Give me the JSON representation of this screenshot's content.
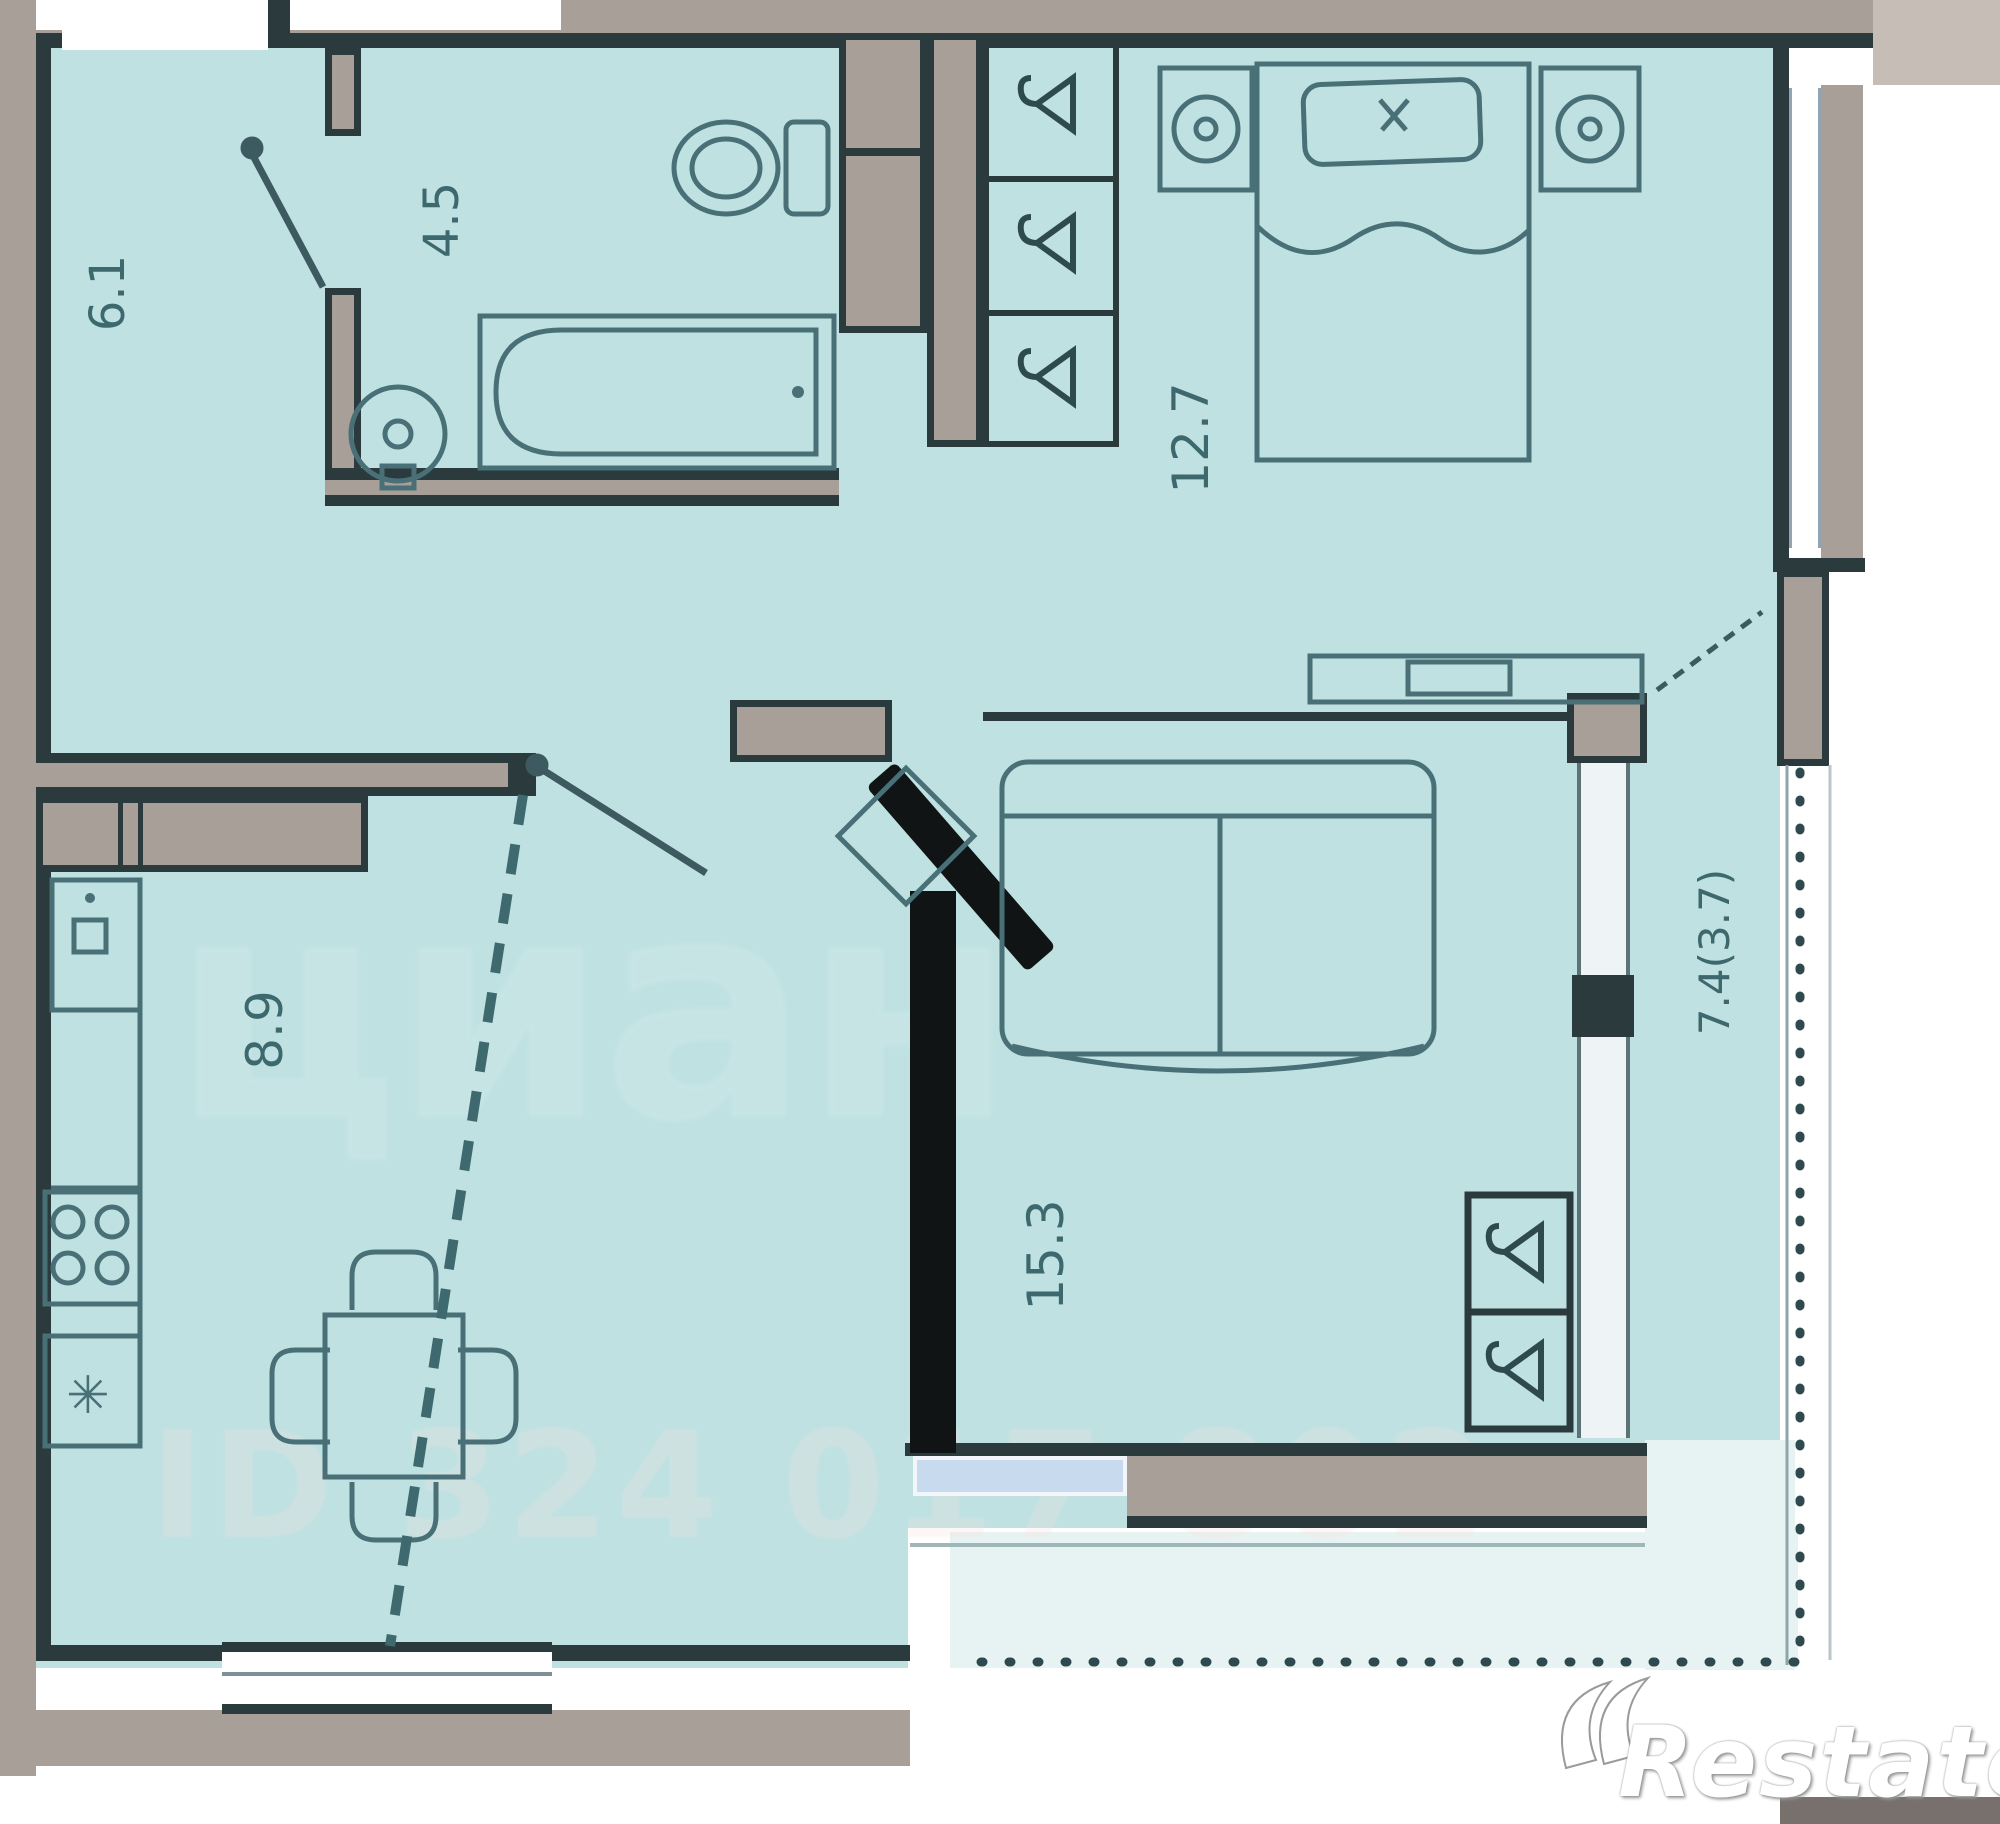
{
  "plan": {
    "type": "apartment-floor-plan",
    "rooms": [
      {
        "id": "hallway",
        "area": "6.1"
      },
      {
        "id": "bathroom",
        "area": "4.5"
      },
      {
        "id": "bedroom",
        "area": "12.7"
      },
      {
        "id": "kitchen",
        "area": "8.9"
      },
      {
        "id": "living_room",
        "area": "15.3"
      },
      {
        "id": "balcony",
        "area": "7.4(3.7)"
      }
    ],
    "icons": {
      "freezer_snowflake": "✳"
    },
    "watermarks": {
      "brand": "Restate",
      "background_text": "циан",
      "listing_id_text": "ID 324 017 802"
    },
    "colors": {
      "room_fill": "#bfe1e2",
      "wall_dark": "#2b3a3d",
      "wall_poche": "#a89f98",
      "window_glass": "#c8daee",
      "furniture_stroke": "#497077",
      "door_leaf_black": "#101415",
      "balcony_pale": "#e7f3f3"
    }
  }
}
